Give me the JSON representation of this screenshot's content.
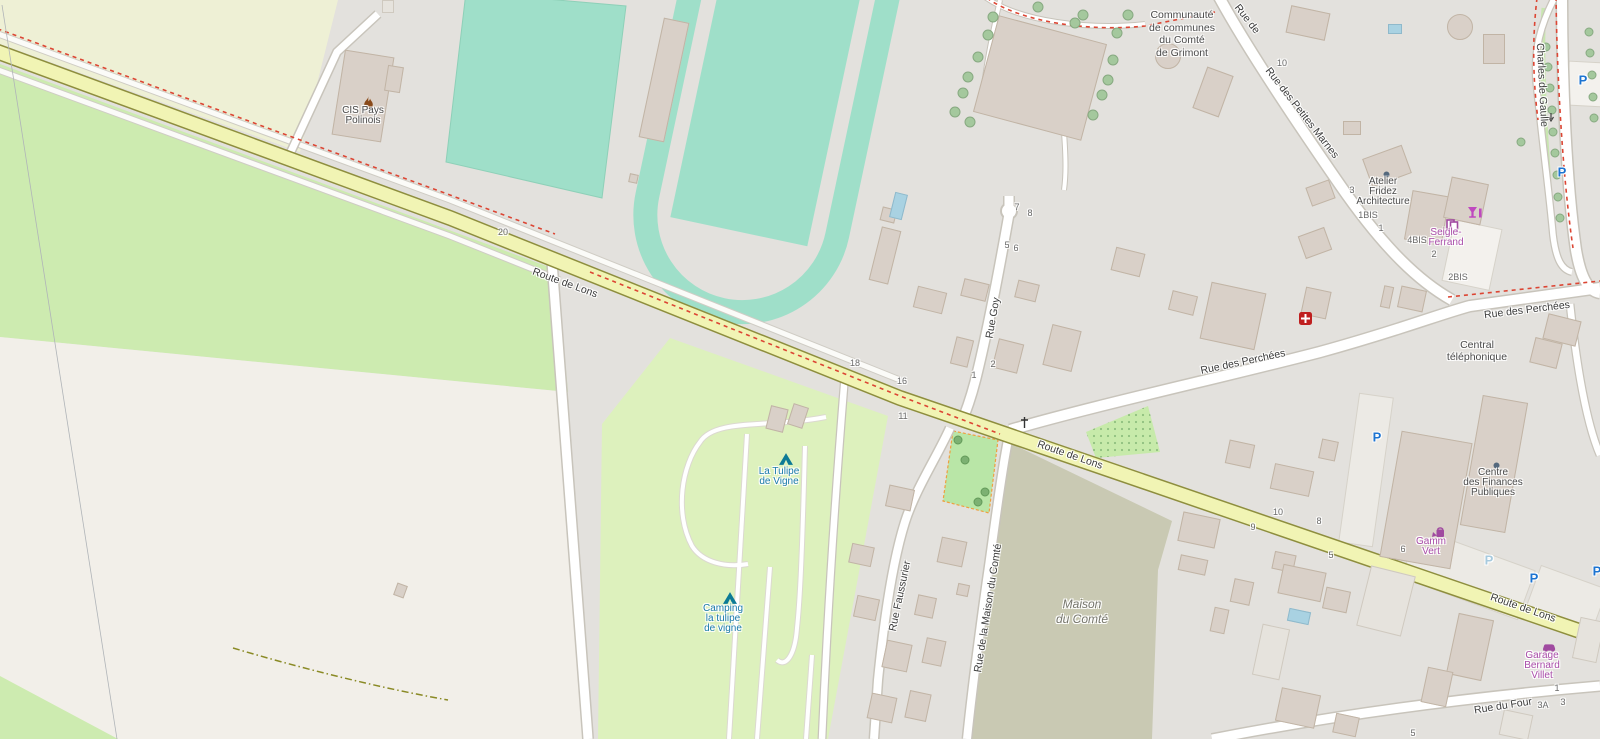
{
  "map_style": "openstreetmap-carto",
  "colors": {
    "residential": "#e3e1dd",
    "farmland": "#eef0d5",
    "meadow": "#cdebb0",
    "field_cream": "#f2efe9",
    "camp_site": "#ddf1bd",
    "pitch_teal": "#9fdfc9",
    "olive_area": "#c9c9b3",
    "playground": "#b9e6a7",
    "road_yellow": "#f1f4b4",
    "road_yellow_casing": "#8e8e3e",
    "road_white": "#ffffff",
    "road_casing": "#c8c4bb",
    "route_red_dash": "#dc4533",
    "building": "#d9d0c8",
    "water": "#a9d2e2",
    "parking_blue": "#1d74d1",
    "parking_pale": "#a7cade",
    "poi_purple": "#a94ca9",
    "camp_label_teal": "#1a7aab",
    "label_dark": "#4a4a4a",
    "number_gray": "#6a6a6a"
  },
  "street_labels": [
    {
      "text": "Route de Lons",
      "x": 565,
      "y": 283,
      "rotate": 20
    },
    {
      "text": "Route de Lons",
      "x": 1070,
      "y": 455,
      "rotate": 19
    },
    {
      "text": "Route de Lons",
      "x": 1523,
      "y": 608,
      "rotate": 19
    },
    {
      "text": "Rue des Perchées",
      "x": 1243,
      "y": 362,
      "rotate": -12
    },
    {
      "text": "Rue des Perchées",
      "x": 1527,
      "y": 310,
      "rotate": -7
    },
    {
      "text": "Rue des Petites Marnes",
      "x": 1302,
      "y": 113,
      "rotate": 52
    },
    {
      "text": "Rue de",
      "x": 1247,
      "y": 19,
      "rotate": 52
    },
    {
      "text": "Rue Goy",
      "x": 993,
      "y": 318,
      "rotate": -80
    },
    {
      "text": "Rue Faussurier",
      "x": 900,
      "y": 596,
      "rotate": -78
    },
    {
      "text": "Rue de la Maison du Comté",
      "x": 988,
      "y": 608,
      "rotate": -81
    },
    {
      "text": "Rue du Four",
      "x": 1503,
      "y": 706,
      "rotate": -9
    },
    {
      "text": "Charles de Gaulle",
      "x": 1542,
      "y": 85,
      "rotate": 87
    }
  ],
  "poi_labels": [
    {
      "lines": [
        "CIS Pays",
        "Polinois"
      ],
      "x": 363,
      "y": 112,
      "color": "dark"
    },
    {
      "lines": [
        "Communauté",
        "de communes",
        "du Comté",
        "de Grimont"
      ],
      "x": 1182,
      "y": 15,
      "color": "dark",
      "size": "big"
    },
    {
      "lines": [
        "Atelier",
        "Fridez",
        "Architecture"
      ],
      "x": 1383,
      "y": 183,
      "color": "dark"
    },
    {
      "lines": [
        "Seigle-",
        "Ferrand"
      ],
      "x": 1446,
      "y": 234,
      "color": "purple"
    },
    {
      "lines": [
        "Central",
        "téléphonique"
      ],
      "x": 1477,
      "y": 345,
      "color": "dark",
      "size": "md"
    },
    {
      "lines": [
        "Centre",
        "des Finances",
        "Publiques"
      ],
      "x": 1493,
      "y": 474,
      "color": "dark"
    },
    {
      "lines": [
        "Gamm",
        "Vert"
      ],
      "x": 1431,
      "y": 543,
      "color": "purple"
    },
    {
      "lines": [
        "Garage",
        "Bernard",
        "Villet"
      ],
      "x": 1542,
      "y": 657,
      "color": "purple"
    },
    {
      "lines": [
        "La Tulipe",
        "de Vigne"
      ],
      "x": 779,
      "y": 473,
      "color": "teal"
    },
    {
      "lines": [
        "Camping",
        "la tulipe",
        "de vigne"
      ],
      "x": 723,
      "y": 610,
      "color": "teal"
    },
    {
      "lines": [
        "Maison",
        "du Comté"
      ],
      "x": 1082,
      "y": 603,
      "color": "area",
      "size": "area"
    }
  ],
  "house_numbers": [
    {
      "t": "20",
      "x": 503,
      "y": 232
    },
    {
      "t": "18",
      "x": 855,
      "y": 363
    },
    {
      "t": "16",
      "x": 902,
      "y": 381
    },
    {
      "t": "11",
      "x": 903,
      "y": 416
    },
    {
      "t": "7",
      "x": 1017,
      "y": 207
    },
    {
      "t": "8",
      "x": 1030,
      "y": 213
    },
    {
      "t": "5",
      "x": 1007,
      "y": 245
    },
    {
      "t": "6",
      "x": 1016,
      "y": 248
    },
    {
      "t": "2",
      "x": 993,
      "y": 364
    },
    {
      "t": "1",
      "x": 974,
      "y": 375
    },
    {
      "t": "10",
      "x": 1282,
      "y": 63
    },
    {
      "t": "3",
      "x": 1352,
      "y": 190
    },
    {
      "t": "1BIS",
      "x": 1368,
      "y": 215
    },
    {
      "t": "1",
      "x": 1381,
      "y": 228
    },
    {
      "t": "4BIS",
      "x": 1417,
      "y": 240
    },
    {
      "t": "2",
      "x": 1434,
      "y": 254
    },
    {
      "t": "2BIS",
      "x": 1458,
      "y": 277
    },
    {
      "t": "10",
      "x": 1278,
      "y": 512
    },
    {
      "t": "9",
      "x": 1253,
      "y": 527
    },
    {
      "t": "8",
      "x": 1319,
      "y": 521
    },
    {
      "t": "5",
      "x": 1331,
      "y": 555
    },
    {
      "t": "6",
      "x": 1403,
      "y": 549
    },
    {
      "t": "5",
      "x": 1413,
      "y": 733
    },
    {
      "t": "3A",
      "x": 1543,
      "y": 705
    },
    {
      "t": "3",
      "x": 1563,
      "y": 702
    },
    {
      "t": "1",
      "x": 1557,
      "y": 688
    }
  ],
  "parking_icons": [
    {
      "x": 1377,
      "y": 437,
      "strong": true
    },
    {
      "x": 1489,
      "y": 560,
      "strong": false
    },
    {
      "x": 1534,
      "y": 578,
      "strong": true
    },
    {
      "x": 1597,
      "y": 571,
      "strong": true
    },
    {
      "x": 1562,
      "y": 172,
      "strong": true
    },
    {
      "x": 1583,
      "y": 80,
      "strong": true
    }
  ],
  "icons": [
    {
      "type": "fire-station",
      "x": 362,
      "y": 96
    },
    {
      "type": "tent",
      "x": 779,
      "y": 453
    },
    {
      "type": "tent",
      "x": 723,
      "y": 592
    },
    {
      "type": "first-aid",
      "x": 1299,
      "y": 312
    },
    {
      "type": "copyshop",
      "x": 1446,
      "y": 219
    },
    {
      "type": "bar",
      "x": 1468,
      "y": 207
    },
    {
      "type": "watering-can",
      "x": 1432,
      "y": 526
    },
    {
      "type": "car-repair",
      "x": 1542,
      "y": 641
    },
    {
      "type": "poi-dot",
      "x": 1383,
      "y": 171
    },
    {
      "type": "poi-dot",
      "x": 1493,
      "y": 462
    },
    {
      "type": "wayside-cross",
      "x": 1020,
      "y": 417
    },
    {
      "type": "oneway-arrow",
      "x": 1547,
      "y": 113
    }
  ],
  "buildings": [
    {
      "x": 664,
      "y": 80,
      "w": 26,
      "h": 122,
      "r": 12
    },
    {
      "x": 633,
      "y": 178,
      "w": 9,
      "h": 9,
      "r": 12
    },
    {
      "x": 363,
      "y": 96,
      "w": 50,
      "h": 86,
      "r": 9
    },
    {
      "x": 394,
      "y": 79,
      "w": 16,
      "h": 26,
      "r": 9
    },
    {
      "x": 388,
      "y": 6,
      "w": 12,
      "h": 13,
      "r": 0,
      "v": "light"
    },
    {
      "x": 1040,
      "y": 78,
      "w": 112,
      "h": 100,
      "r": 15
    },
    {
      "x": 1168,
      "y": 56,
      "w": 26,
      "h": 26,
      "r": 0,
      "shape": "circle"
    },
    {
      "x": 1213,
      "y": 92,
      "w": 28,
      "h": 44,
      "r": 20
    },
    {
      "x": 1308,
      "y": 23,
      "w": 40,
      "h": 28,
      "r": 12
    },
    {
      "x": 1494,
      "y": 49,
      "w": 22,
      "h": 30,
      "r": 0
    },
    {
      "x": 1460,
      "y": 27,
      "w": 26,
      "h": 26,
      "r": 0,
      "shape": "circle"
    },
    {
      "x": 1352,
      "y": 128,
      "w": 18,
      "h": 14,
      "r": 0
    },
    {
      "x": 1387,
      "y": 166,
      "w": 42,
      "h": 30,
      "r": -20
    },
    {
      "x": 1320,
      "y": 193,
      "w": 25,
      "h": 20,
      "r": -20
    },
    {
      "x": 1315,
      "y": 243,
      "w": 28,
      "h": 24,
      "r": -20
    },
    {
      "x": 1427,
      "y": 218,
      "w": 38,
      "h": 50,
      "r": 10
    },
    {
      "x": 1466,
      "y": 201,
      "w": 38,
      "h": 42,
      "r": 12
    },
    {
      "x": 1546,
      "y": 353,
      "w": 28,
      "h": 26,
      "r": 14
    },
    {
      "x": 1562,
      "y": 330,
      "w": 34,
      "h": 26,
      "r": 14
    },
    {
      "x": 1233,
      "y": 316,
      "w": 56,
      "h": 58,
      "r": 12
    },
    {
      "x": 1316,
      "y": 303,
      "w": 26,
      "h": 28,
      "r": 12
    },
    {
      "x": 1387,
      "y": 297,
      "w": 10,
      "h": 22,
      "r": 12
    },
    {
      "x": 1412,
      "y": 299,
      "w": 26,
      "h": 22,
      "r": 12
    },
    {
      "x": 1128,
      "y": 262,
      "w": 30,
      "h": 24,
      "r": 14
    },
    {
      "x": 1183,
      "y": 303,
      "w": 26,
      "h": 20,
      "r": 14
    },
    {
      "x": 1494,
      "y": 464,
      "w": 46,
      "h": 132,
      "r": 10
    },
    {
      "x": 1426,
      "y": 500,
      "w": 72,
      "h": 128,
      "r": 10
    },
    {
      "x": 885,
      "y": 255,
      "w": 20,
      "h": 55,
      "r": 14
    },
    {
      "x": 888,
      "y": 215,
      "w": 15,
      "h": 14,
      "r": 14
    },
    {
      "x": 930,
      "y": 300,
      "w": 30,
      "h": 22,
      "r": 14
    },
    {
      "x": 975,
      "y": 290,
      "w": 26,
      "h": 18,
      "r": 14
    },
    {
      "x": 1027,
      "y": 291,
      "w": 22,
      "h": 18,
      "r": 14
    },
    {
      "x": 962,
      "y": 352,
      "w": 18,
      "h": 28,
      "r": 14
    },
    {
      "x": 1008,
      "y": 356,
      "w": 26,
      "h": 30,
      "r": 14
    },
    {
      "x": 1062,
      "y": 348,
      "w": 30,
      "h": 42,
      "r": 14
    },
    {
      "x": 1240,
      "y": 454,
      "w": 26,
      "h": 24,
      "r": 12
    },
    {
      "x": 1292,
      "y": 480,
      "w": 40,
      "h": 26,
      "r": 12
    },
    {
      "x": 1328,
      "y": 450,
      "w": 17,
      "h": 20,
      "r": 12
    },
    {
      "x": 1199,
      "y": 530,
      "w": 38,
      "h": 30,
      "r": 12
    },
    {
      "x": 1193,
      "y": 565,
      "w": 28,
      "h": 16,
      "r": 12
    },
    {
      "x": 1242,
      "y": 592,
      "w": 20,
      "h": 24,
      "r": 12
    },
    {
      "x": 1284,
      "y": 562,
      "w": 22,
      "h": 18,
      "r": 12
    },
    {
      "x": 1302,
      "y": 583,
      "w": 44,
      "h": 30,
      "r": 12
    },
    {
      "x": 1336,
      "y": 600,
      "w": 25,
      "h": 22,
      "r": 12
    },
    {
      "x": 1386,
      "y": 601,
      "w": 46,
      "h": 62,
      "r": 14,
      "v": "light"
    },
    {
      "x": 1219,
      "y": 620,
      "w": 15,
      "h": 25,
      "r": 12
    },
    {
      "x": 1271,
      "y": 652,
      "w": 28,
      "h": 52,
      "r": 12,
      "v": "light"
    },
    {
      "x": 777,
      "y": 419,
      "w": 18,
      "h": 24,
      "r": 14
    },
    {
      "x": 798,
      "y": 416,
      "w": 16,
      "h": 22,
      "r": 18
    },
    {
      "x": 900,
      "y": 498,
      "w": 26,
      "h": 22,
      "r": 12
    },
    {
      "x": 861,
      "y": 555,
      "w": 23,
      "h": 20,
      "r": 12
    },
    {
      "x": 952,
      "y": 552,
      "w": 26,
      "h": 26,
      "r": 12
    },
    {
      "x": 866,
      "y": 608,
      "w": 23,
      "h": 22,
      "r": 12
    },
    {
      "x": 925,
      "y": 606,
      "w": 19,
      "h": 21,
      "r": 12
    },
    {
      "x": 963,
      "y": 590,
      "w": 12,
      "h": 12,
      "r": 12
    },
    {
      "x": 897,
      "y": 656,
      "w": 26,
      "h": 28,
      "r": 12
    },
    {
      "x": 934,
      "y": 652,
      "w": 20,
      "h": 26,
      "r": 12
    },
    {
      "x": 882,
      "y": 708,
      "w": 26,
      "h": 26,
      "r": 12
    },
    {
      "x": 918,
      "y": 706,
      "w": 22,
      "h": 28,
      "r": 12
    },
    {
      "x": 400,
      "y": 590,
      "w": 11,
      "h": 13,
      "r": 20
    },
    {
      "x": 1470,
      "y": 647,
      "w": 36,
      "h": 62,
      "r": 12
    },
    {
      "x": 1437,
      "y": 687,
      "w": 26,
      "h": 36,
      "r": 12
    },
    {
      "x": 1588,
      "y": 640,
      "w": 25,
      "h": 42,
      "r": 12,
      "v": "light"
    },
    {
      "x": 1516,
      "y": 725,
      "w": 30,
      "h": 26,
      "r": 12,
      "v": "light"
    },
    {
      "x": 1298,
      "y": 708,
      "w": 40,
      "h": 34,
      "r": 12
    },
    {
      "x": 1346,
      "y": 725,
      "w": 24,
      "h": 20,
      "r": 12
    }
  ],
  "trees": [
    {
      "x": 1038,
      "y": 7
    },
    {
      "x": 993,
      "y": 17
    },
    {
      "x": 1083,
      "y": 15
    },
    {
      "x": 1075,
      "y": 23
    },
    {
      "x": 988,
      "y": 35
    },
    {
      "x": 978,
      "y": 57
    },
    {
      "x": 968,
      "y": 77
    },
    {
      "x": 963,
      "y": 93
    },
    {
      "x": 955,
      "y": 112
    },
    {
      "x": 970,
      "y": 122
    },
    {
      "x": 1113,
      "y": 60
    },
    {
      "x": 1108,
      "y": 80
    },
    {
      "x": 1102,
      "y": 95
    },
    {
      "x": 1093,
      "y": 115
    },
    {
      "x": 1128,
      "y": 15
    },
    {
      "x": 1117,
      "y": 33
    },
    {
      "x": 1546,
      "y": 47,
      "k": "s"
    },
    {
      "x": 1548,
      "y": 67,
      "k": "s"
    },
    {
      "x": 1550,
      "y": 88,
      "k": "s"
    },
    {
      "x": 1552,
      "y": 110,
      "k": "s"
    },
    {
      "x": 1553,
      "y": 132,
      "k": "s"
    },
    {
      "x": 1555,
      "y": 153,
      "k": "s"
    },
    {
      "x": 1557,
      "y": 175,
      "k": "s"
    },
    {
      "x": 1558,
      "y": 197,
      "k": "s"
    },
    {
      "x": 1560,
      "y": 218,
      "k": "s"
    },
    {
      "x": 1589,
      "y": 32,
      "k": "s"
    },
    {
      "x": 1590,
      "y": 53,
      "k": "s"
    },
    {
      "x": 1592,
      "y": 75,
      "k": "s"
    },
    {
      "x": 1593,
      "y": 97,
      "k": "s"
    },
    {
      "x": 1594,
      "y": 118,
      "k": "s"
    },
    {
      "x": 1521,
      "y": 142,
      "k": "s"
    },
    {
      "x": 965,
      "y": 460,
      "k": "d"
    },
    {
      "x": 985,
      "y": 492,
      "k": "d"
    },
    {
      "x": 978,
      "y": 502,
      "k": "d"
    },
    {
      "x": 958,
      "y": 440,
      "k": "d"
    }
  ],
  "pools": [
    {
      "x": 898,
      "y": 206,
      "w": 13,
      "h": 26,
      "r": 14
    },
    {
      "x": 1299,
      "y": 616,
      "w": 22,
      "h": 13,
      "r": 12
    },
    {
      "x": 1395,
      "y": 29,
      "w": 14,
      "h": 10,
      "r": 0
    }
  ]
}
